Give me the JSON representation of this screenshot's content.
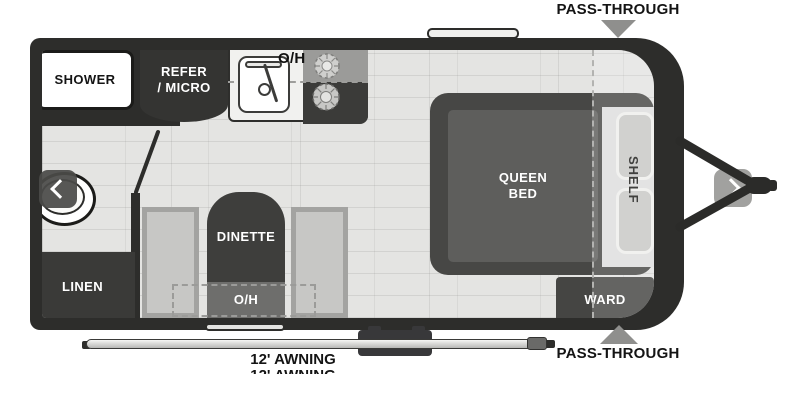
{
  "floorplan": {
    "exterior": {
      "pass_through_top": "PASS-THROUGH",
      "pass_through_bottom": "PASS-THROUGH",
      "awning_label": "12' AWNING",
      "awning_label_clipped": "12' AWNING"
    },
    "rooms": {
      "shower": "SHOWER",
      "refer_micro": {
        "line1": "REFER",
        "line2": "/ MICRO"
      },
      "kitchen_overhead": "O/H",
      "dinette": "DINETTE",
      "dinette_overhead": "O/H",
      "linen": "LINEN",
      "queen_bed": {
        "line1": "QUEEN",
        "line2": "BED"
      },
      "shelf": "SHELF",
      "ward": "WARD"
    },
    "nav": {
      "prev_icon": "chevron-left",
      "next_icon": "chevron-right"
    },
    "colors": {
      "wall": "#2d2d2b",
      "floor": "#e4e4e2",
      "dark_furniture": "#3b3b39",
      "bench": "#a3a3a1",
      "counter": "#f1f1ef",
      "mattress": "#5e5e5c",
      "arrow_gray": "#8f8f8d",
      "background": "#ffffff"
    }
  }
}
